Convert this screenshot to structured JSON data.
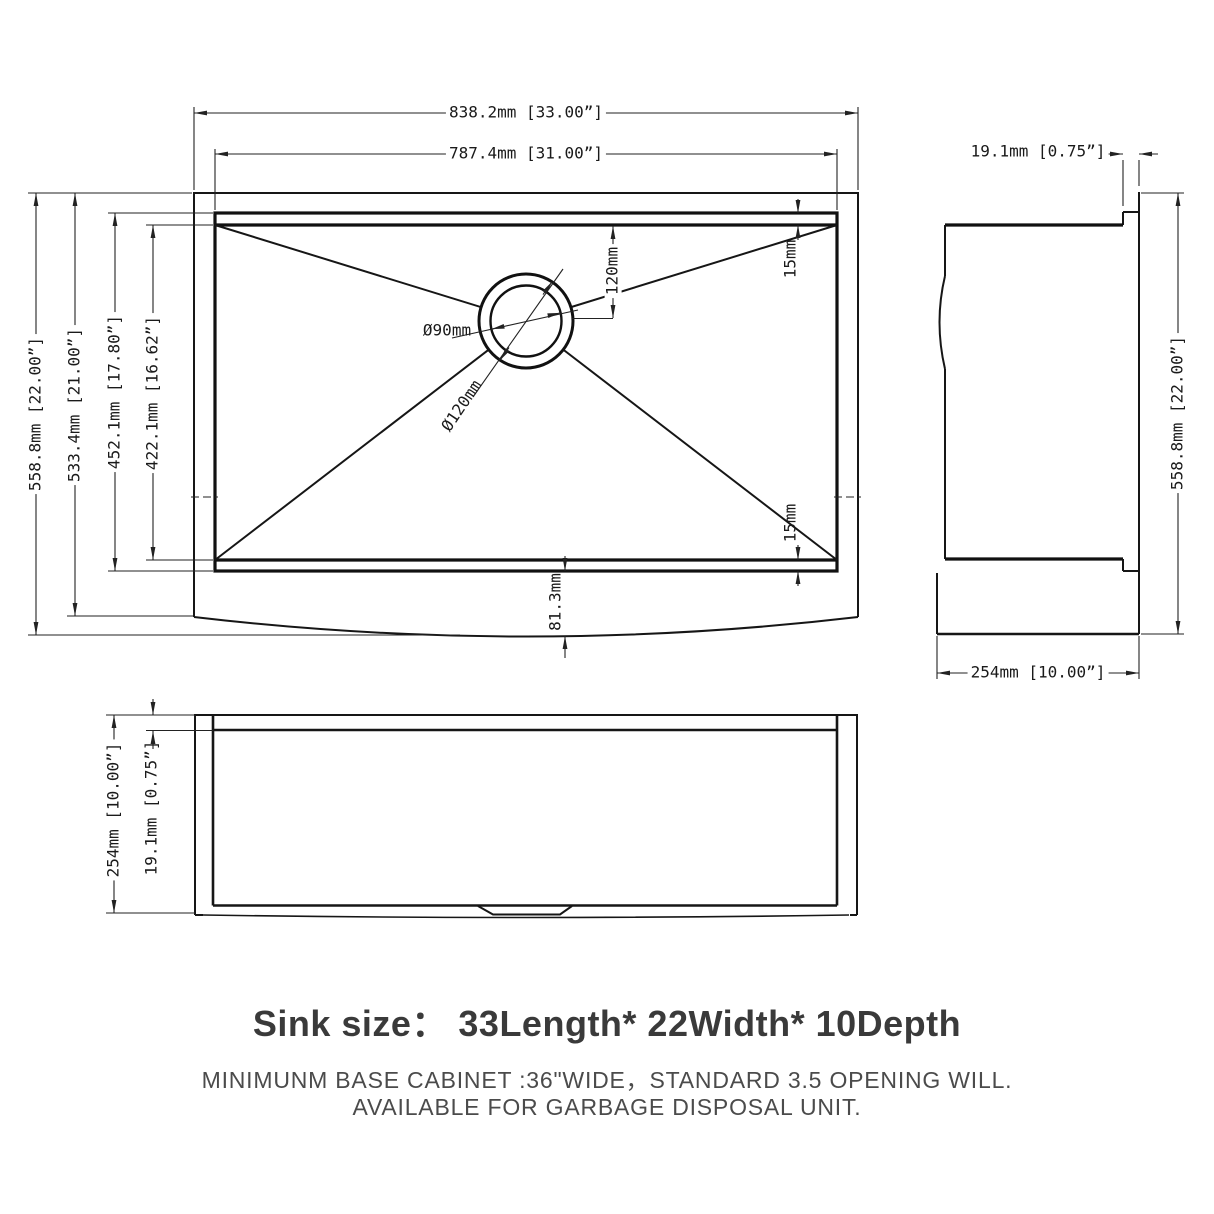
{
  "plan_view": {
    "overall_width": "838.2mm [33.00”]",
    "bowl_width": "787.4mm [31.00”]",
    "overall_depth": "558.8mm [22.00”]",
    "inner_depth": "533.4mm [21.00”]",
    "bowl_depth": "452.1mm [17.80”]",
    "bowl_floor_depth": "422.1mm [16.62”]",
    "drain_hole_diameter": "Ø90mm",
    "drain_recess_diameter": "Ø120mm",
    "drain_offset": "120mm",
    "corner_radius_back": "15mm",
    "corner_radius_front": "15mm",
    "apron_bow": "81.3mm"
  },
  "side_view": {
    "rim_thickness": "19.1mm [0.75”]",
    "overall_depth": "558.8mm [22.00”]",
    "height": "254mm [10.00”]"
  },
  "front_view": {
    "height": "254mm [10.00”]",
    "rim_thickness": "19.1mm [0.75”]"
  },
  "caption": {
    "title": "Sink size：  33Length* 22Width* 10Depth",
    "note_line1": "MINIMUNM BASE CABINET :36\"WIDE，STANDARD 3.5 OPENING WILL.",
    "note_line2": "AVAILABLE FOR GARBAGE DISPOSAL UNIT."
  }
}
